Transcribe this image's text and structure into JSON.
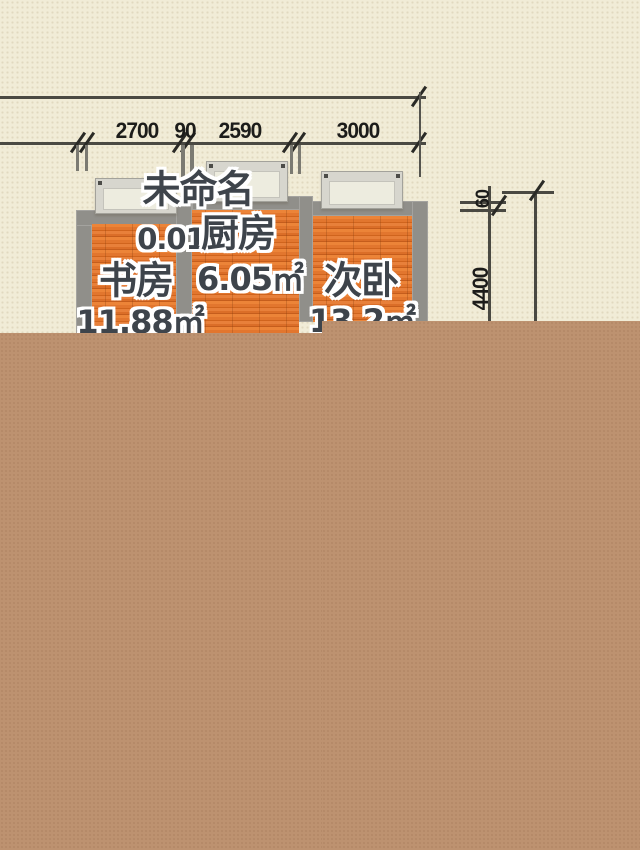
{
  "page": {
    "type": "residential floor plan drawing, partially rendered"
  },
  "colors": {
    "canvas-bg": "#f1ecd7",
    "cover": "#bd9270",
    "wall": "#908f8a",
    "floor": "#e2762e",
    "dim-line": "#4a4942",
    "dim-text": "#1c1c1a",
    "label-text": "#3e444b",
    "window-frame": "#d7d6ce",
    "window-pane": "#edecdf"
  },
  "dimensions": {
    "top_labels": [
      "2700",
      "90",
      "2590",
      "3000"
    ],
    "right_labels": [
      "60",
      "4400"
    ]
  },
  "rooms": [
    {
      "name": "未命名",
      "area": "0.01㎡"
    },
    {
      "name": "厨房",
      "area": "6.05㎡"
    },
    {
      "name": "书房",
      "area": "11.88㎡"
    },
    {
      "name": "次卧",
      "area": "13.2㎡"
    }
  ]
}
